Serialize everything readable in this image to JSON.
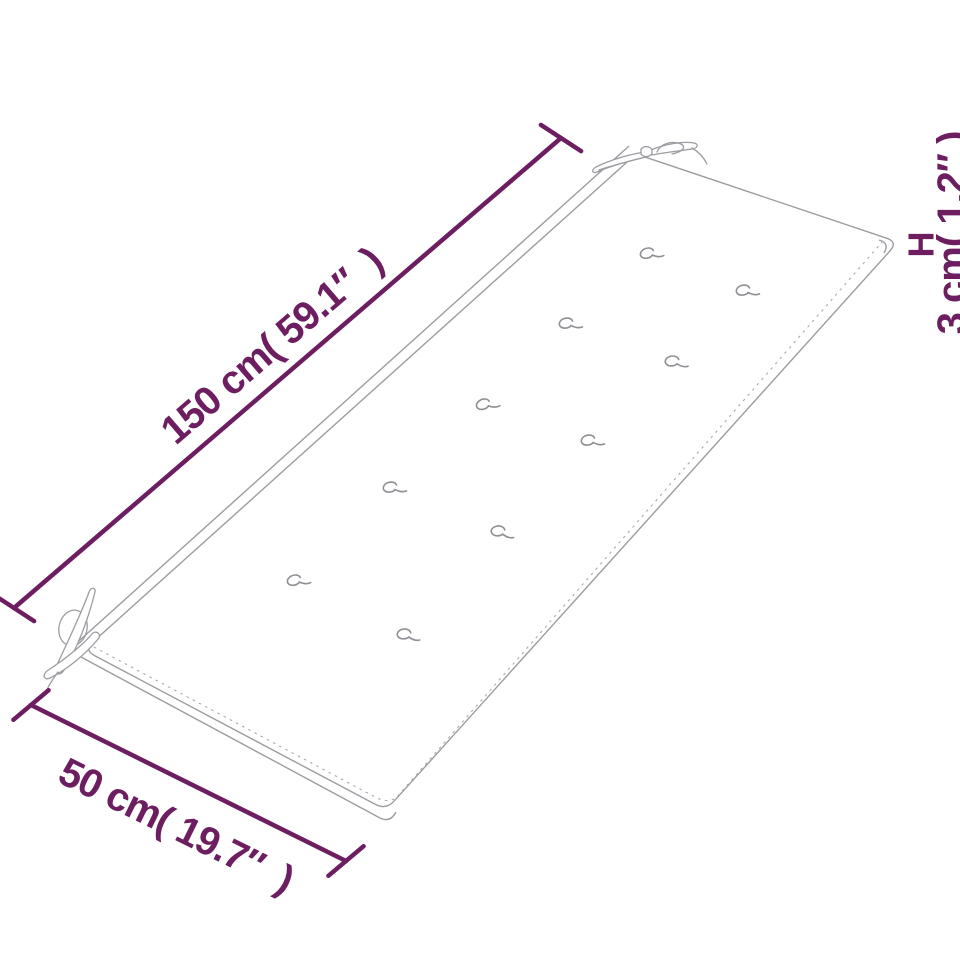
{
  "diagram": {
    "colors": {
      "accent": "#6d1e60",
      "outline": "#9c9ca2",
      "seam": "#a9a9ae",
      "tuft": "#8e8e94",
      "bg": "#ffffff"
    },
    "dimensions": {
      "length": {
        "label": "150 cm( 59.1″  )",
        "value_cm": 150,
        "value_in": 59.1
      },
      "width": {
        "label": "50 cm( 19.7″  )",
        "value_cm": 50,
        "value_in": 19.7
      },
      "height": {
        "label": "3 cm( 1.2″ )",
        "value_cm": 3,
        "value_in": 1.2,
        "axis_label": "H"
      }
    },
    "features": {
      "tuft_button_count": 10,
      "tie_strap_corner_count": 2
    }
  }
}
